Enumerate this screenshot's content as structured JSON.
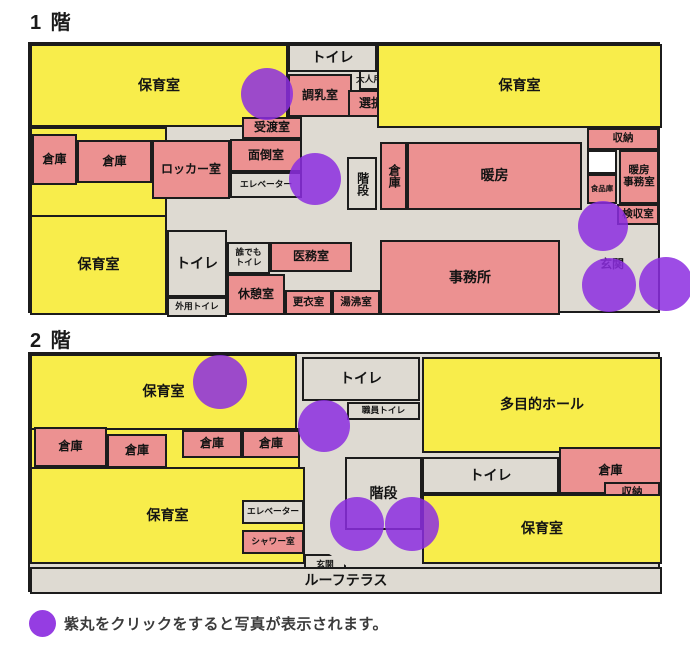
{
  "legend": {
    "text": "紫丸をクリックをすると写真が表示されます。"
  },
  "colors": {
    "room_yellow": "#f8ed4b",
    "room_pink": "#ec9191",
    "corridor_gray": "#dedad2",
    "room_white": "#ffffff",
    "photo_purple": "#8c2de0",
    "outline_black": "#1c1c1c"
  },
  "floor1": {
    "title": "1 階",
    "rooms": [
      {
        "name": "nursery-room-nw",
        "label": "保育室",
        "type": "yellow",
        "fs": "lg",
        "x": 0,
        "y": 0,
        "w": 258,
        "h": 83
      },
      {
        "name": "nursery-west-area",
        "label": "",
        "type": "yellow",
        "fs": "md",
        "x": 0,
        "y": 83,
        "w": 137,
        "h": 90
      },
      {
        "name": "nursery-room-sw",
        "label": "保育室",
        "type": "yellow",
        "fs": "lg",
        "x": 0,
        "y": 171,
        "w": 137,
        "h": 100
      },
      {
        "name": "toilet-north",
        "label": "トイレ",
        "type": "gray",
        "fs": "lg",
        "x": 258,
        "y": 0,
        "w": 89,
        "h": 28
      },
      {
        "name": "milk-prep-room",
        "label": "調乳室",
        "type": "pink",
        "fs": "md",
        "x": 258,
        "y": 30,
        "w": 64,
        "h": 43
      },
      {
        "name": "adult-toilet",
        "label": "大人用トイレ",
        "type": "gray",
        "fs": "xs",
        "x": 329,
        "y": 26,
        "w": 46,
        "h": 20
      },
      {
        "name": "laundry-room",
        "label": "選択室",
        "type": "pink",
        "fs": "md",
        "x": 318,
        "y": 46,
        "w": 58,
        "h": 27
      },
      {
        "name": "handover-room",
        "label": "受渡室",
        "type": "pink",
        "fs": "md",
        "x": 212,
        "y": 73,
        "w": 60,
        "h": 22
      },
      {
        "name": "care-room",
        "label": "面倒室",
        "type": "pink",
        "fs": "md",
        "x": 200,
        "y": 95,
        "w": 72,
        "h": 33
      },
      {
        "name": "locker-room",
        "label": "ロッカー室",
        "type": "pink",
        "fs": "md",
        "x": 122,
        "y": 96,
        "w": 78,
        "h": 59
      },
      {
        "name": "elevator",
        "label": "エレベーター",
        "type": "gray",
        "fs": "xs",
        "x": 200,
        "y": 128,
        "w": 72,
        "h": 26
      },
      {
        "name": "storage-a",
        "label": "倉庫",
        "type": "pink",
        "fs": "md",
        "x": 2,
        "y": 90,
        "w": 45,
        "h": 51
      },
      {
        "name": "storage-b",
        "label": "倉庫",
        "type": "pink",
        "fs": "md",
        "x": 47,
        "y": 96,
        "w": 75,
        "h": 43
      },
      {
        "name": "toilet-west",
        "label": "トイレ",
        "type": "gray",
        "fs": "lg",
        "x": 137,
        "y": 186,
        "w": 60,
        "h": 67
      },
      {
        "name": "outdoor-toilet",
        "label": "外用トイレ",
        "type": "gray",
        "fs": "xs",
        "x": 137,
        "y": 253,
        "w": 60,
        "h": 20
      },
      {
        "name": "accessible-toilet",
        "lines": [
          "誰でも",
          "トイレ"
        ],
        "type": "gray",
        "fs": "xs",
        "x": 197,
        "y": 198,
        "w": 43,
        "h": 32
      },
      {
        "name": "medical-room",
        "label": "医務室",
        "type": "pink",
        "fs": "md",
        "x": 240,
        "y": 198,
        "w": 82,
        "h": 30
      },
      {
        "name": "break-room",
        "label": "休憩室",
        "type": "pink",
        "fs": "md",
        "x": 197,
        "y": 230,
        "w": 58,
        "h": 41
      },
      {
        "name": "changing-room",
        "label": "更衣室",
        "type": "pink",
        "fs": "sm",
        "x": 255,
        "y": 246,
        "w": 47,
        "h": 25
      },
      {
        "name": "hot-water-room",
        "label": "湯沸室",
        "type": "pink",
        "fs": "sm",
        "x": 302,
        "y": 246,
        "w": 48,
        "h": 25
      },
      {
        "name": "office",
        "label": "事務所",
        "type": "pink",
        "fs": "lg",
        "x": 350,
        "y": 196,
        "w": 180,
        "h": 75
      },
      {
        "name": "stairs",
        "label": "階段",
        "type": "gray",
        "fs": "md",
        "vertical": true,
        "x": 317,
        "y": 113,
        "w": 30,
        "h": 53
      },
      {
        "name": "storage-c",
        "label": "倉庫",
        "type": "pink",
        "fs": "md",
        "vertical": true,
        "x": 350,
        "y": 98,
        "w": 27,
        "h": 68
      },
      {
        "name": "heating-room",
        "label": "暖房",
        "type": "pink",
        "fs": "lg",
        "x": 377,
        "y": 98,
        "w": 175,
        "h": 68
      },
      {
        "name": "nursery-room-ne",
        "label": "保育室",
        "type": "yellow",
        "fs": "lg",
        "x": 347,
        "y": 0,
        "w": 285,
        "h": 84
      },
      {
        "name": "storage-shelf",
        "label": "収納",
        "type": "pink",
        "fs": "sm",
        "x": 557,
        "y": 84,
        "w": 72,
        "h": 22
      },
      {
        "name": "unlabeled-room",
        "label": "",
        "type": "white",
        "fs": "sm",
        "x": 557,
        "y": 106,
        "w": 30,
        "h": 24
      },
      {
        "name": "food-storage",
        "label": "食品庫",
        "type": "pink",
        "fs": "xxs",
        "x": 557,
        "y": 130,
        "w": 30,
        "h": 30
      },
      {
        "name": "heating-office",
        "lines": [
          "暖房",
          "事務室"
        ],
        "type": "pink",
        "fs": "sm",
        "x": 589,
        "y": 106,
        "w": 40,
        "h": 54
      },
      {
        "name": "inspection-room",
        "label": "検収室",
        "type": "pink",
        "fs": "sm",
        "x": 587,
        "y": 160,
        "w": 42,
        "h": 21
      },
      {
        "name": "entrance-label",
        "label": "玄関",
        "type": "none",
        "fs": "md",
        "x": 559,
        "y": 212,
        "w": 46,
        "h": 18
      }
    ],
    "circles": [
      {
        "x": 237,
        "y": 50,
        "r": 26
      },
      {
        "x": 285,
        "y": 135,
        "r": 26
      },
      {
        "x": 573,
        "y": 182,
        "r": 25
      },
      {
        "x": 579,
        "y": 241,
        "r": 27
      },
      {
        "x": 636,
        "y": 240,
        "r": 27
      }
    ]
  },
  "floor2": {
    "title": "2 階",
    "rooms": [
      {
        "name": "nursery-room-n",
        "label": "保育室",
        "type": "yellow",
        "fs": "lg",
        "x": 0,
        "y": 0,
        "w": 267,
        "h": 76
      },
      {
        "name": "nursery-west-area",
        "label": "",
        "type": "yellow",
        "fs": "md",
        "x": 0,
        "y": 74,
        "w": 270,
        "h": 41
      },
      {
        "name": "nursery-room-sw",
        "label": "保育室",
        "type": "yellow",
        "fs": "lg",
        "x": 0,
        "y": 113,
        "w": 275,
        "h": 97
      },
      {
        "name": "storage-1",
        "label": "倉庫",
        "type": "pink",
        "fs": "md",
        "x": 4,
        "y": 73,
        "w": 73,
        "h": 40
      },
      {
        "name": "storage-2",
        "label": "倉庫",
        "type": "pink",
        "fs": "md",
        "x": 77,
        "y": 80,
        "w": 60,
        "h": 34
      },
      {
        "name": "storage-3",
        "label": "倉庫",
        "type": "pink",
        "fs": "md",
        "x": 152,
        "y": 76,
        "w": 60,
        "h": 28
      },
      {
        "name": "storage-4",
        "label": "倉庫",
        "type": "pink",
        "fs": "md",
        "x": 212,
        "y": 76,
        "w": 58,
        "h": 28
      },
      {
        "name": "toilet-north",
        "label": "トイレ",
        "type": "gray",
        "fs": "lg",
        "x": 272,
        "y": 3,
        "w": 118,
        "h": 44
      },
      {
        "name": "staff-toilet",
        "label": "職員トイレ",
        "type": "gray",
        "fs": "xs",
        "x": 317,
        "y": 48,
        "w": 73,
        "h": 18
      },
      {
        "name": "multipurpose-hall",
        "label": "多目的ホール",
        "type": "yellow",
        "fs": "lg",
        "x": 392,
        "y": 3,
        "w": 240,
        "h": 96
      },
      {
        "name": "storage-east",
        "label": "倉庫",
        "type": "pink",
        "fs": "md",
        "x": 529,
        "y": 93,
        "w": 103,
        "h": 47
      },
      {
        "name": "storage-shelf",
        "label": "収納",
        "type": "pink",
        "fs": "sm",
        "x": 574,
        "y": 128,
        "w": 56,
        "h": 21
      },
      {
        "name": "toilet-east",
        "label": "トイレ",
        "type": "gray",
        "fs": "lg",
        "x": 392,
        "y": 103,
        "w": 137,
        "h": 37
      },
      {
        "name": "stairs",
        "label": "階段",
        "type": "gray",
        "fs": "lg",
        "x": 315,
        "y": 103,
        "w": 77,
        "h": 73
      },
      {
        "name": "nursery-room-se",
        "label": "保育室",
        "type": "yellow",
        "fs": "lg",
        "x": 392,
        "y": 140,
        "w": 240,
        "h": 70
      },
      {
        "name": "elevator",
        "label": "エレベーター",
        "type": "gray",
        "fs": "xs",
        "x": 212,
        "y": 146,
        "w": 62,
        "h": 24
      },
      {
        "name": "shower-room",
        "label": "シャワー室",
        "type": "pink",
        "fs": "xs",
        "x": 212,
        "y": 176,
        "w": 62,
        "h": 24
      },
      {
        "name": "entrance",
        "label": "玄関",
        "type": "gray",
        "fs": "xs",
        "shape": "pentagon",
        "x": 274,
        "y": 200,
        "w": 42,
        "h": 21
      },
      {
        "name": "roof-terrace",
        "label": "ルーフテラス",
        "type": "gray",
        "fs": "lg",
        "x": 0,
        "y": 213,
        "w": 632,
        "h": 27
      }
    ],
    "circles": [
      {
        "x": 190,
        "y": 28,
        "r": 27
      },
      {
        "x": 294,
        "y": 72,
        "r": 26
      },
      {
        "x": 327,
        "y": 170,
        "r": 27
      },
      {
        "x": 382,
        "y": 170,
        "r": 27
      }
    ]
  }
}
